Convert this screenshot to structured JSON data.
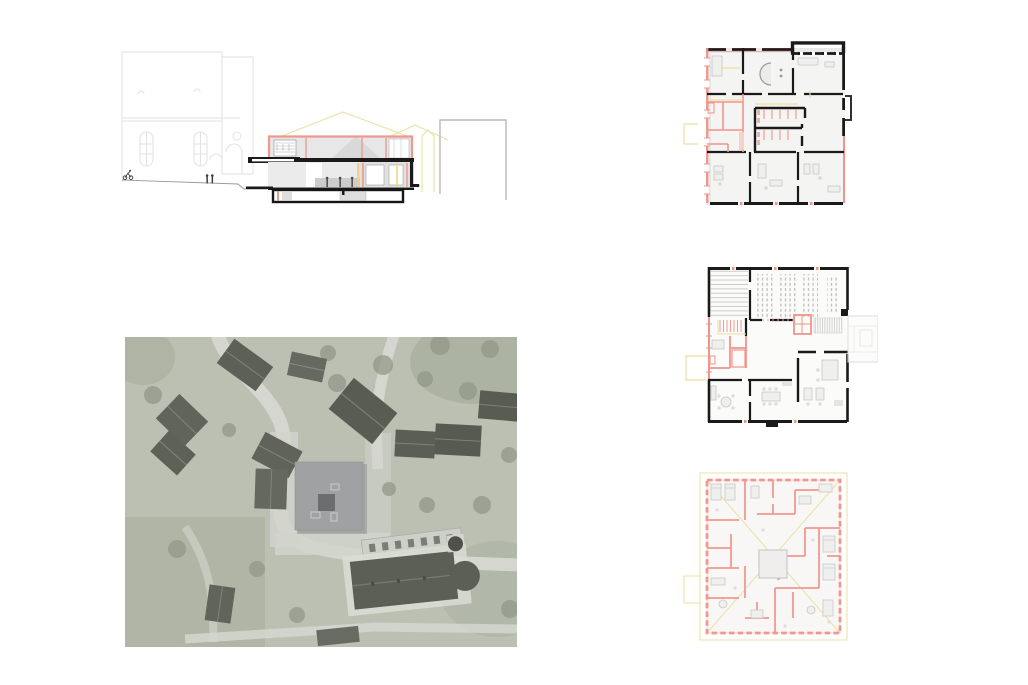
{
  "panels": {
    "section": {
      "name": "building-section-elevation"
    },
    "aerial": {
      "name": "aerial-site-photograph"
    },
    "plan_top": {
      "name": "floor-plan-level-1"
    },
    "plan_middle": {
      "name": "floor-plan-level-2"
    },
    "plan_bottom": {
      "name": "floor-plan-level-3"
    }
  },
  "colors": {
    "wall_black": "#1a1a1a",
    "plan_red": "#f0948b",
    "plan_red_light": "#f8d0ca",
    "section_red": "#f0988f",
    "accent_yellow": "#eadfa2",
    "faint_gray": "#e2e2e2",
    "poche_gray": "#e8e8e8",
    "furniture_gray": "#d9d9d9",
    "photo_base": "#bac0b2",
    "photo_road": "#d7d9d2",
    "photo_roof_dark": "#50544b",
    "photo_green": "#8d9484",
    "overlay_building": "#9b9ea1",
    "overlay_core": "#626467"
  }
}
